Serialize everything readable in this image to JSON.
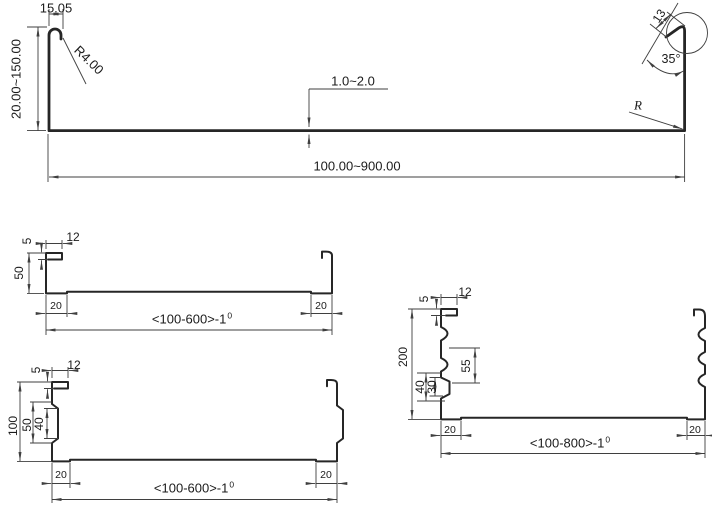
{
  "palette": {
    "background": "#ffffff",
    "profile_line": "#262626",
    "dimension_line": "#3f3f3f",
    "text": "#1b1b1b"
  },
  "drawing": {
    "panel": {
      "hook_width": "15.05",
      "hook_radius": "R4.00",
      "leg_height": "20.00~150.00",
      "thickness": "1.0~2.0",
      "width": "100.00~900.00",
      "tip_length": "13",
      "tip_angle": "35°",
      "corner_radius": "R"
    },
    "tray50": {
      "lip_height": "5",
      "lip_width": "12",
      "wall_height": "50",
      "end_left": "20",
      "end_right": "20",
      "width_base": "<100-600>-1",
      "width_tolerance": "0"
    },
    "tray100": {
      "lip_height": "5",
      "lip_width": "12",
      "wall_height": "100",
      "rib_outer": "50",
      "rib_inner": "40",
      "end_left": "20",
      "end_right": "20",
      "width_base": "<100-600>-1",
      "width_tolerance": "0"
    },
    "tray200": {
      "lip_height": "5",
      "lip_width": "12",
      "wall_height": "200",
      "rib_spacing": "55",
      "rib_outer": "40",
      "rib_inner": "30",
      "end_left": "20",
      "end_right": "20",
      "width_base": "<100-800>-1",
      "width_tolerance": "0"
    }
  }
}
